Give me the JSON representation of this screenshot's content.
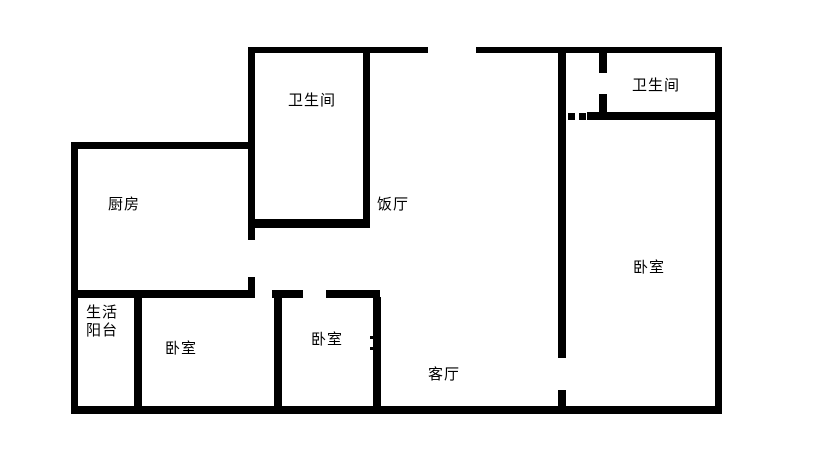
{
  "rooms": {
    "kitchen": {
      "label": "厨房"
    },
    "bathroom_top": {
      "label": "卫生间"
    },
    "dining": {
      "label": "饭厅"
    },
    "bathroom_right": {
      "label": "卫生间"
    },
    "bedroom_right": {
      "label": "卧室"
    },
    "bedroom_left": {
      "label": "卧室"
    },
    "bedroom_middle": {
      "label": "卧室"
    },
    "living_room": {
      "label": "客厅"
    },
    "utility_balcony": {
      "label": "生活阳台",
      "line1": "生活",
      "line2": "阳台"
    }
  },
  "colors": {
    "wall": "#000000",
    "background": "#ffffff"
  }
}
